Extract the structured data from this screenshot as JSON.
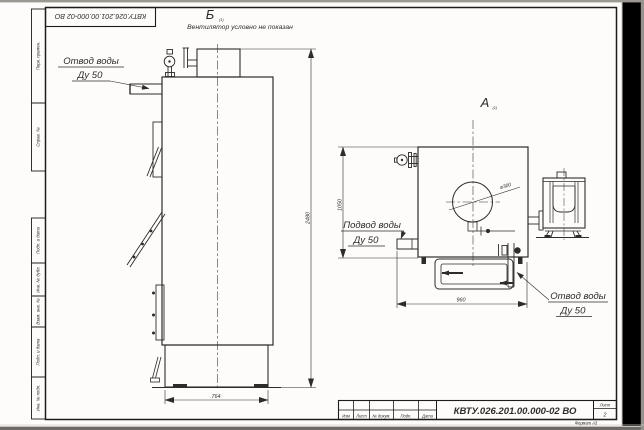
{
  "watermark": {
    "text": "kotel-kv.kz"
  },
  "corner_stamp": {
    "doc_number": "КВТУ.026.201.00.000-02  ВО"
  },
  "margin": [
    "Перв. примен.",
    "Справ. №",
    "Подп. и дата",
    "Инв. № дубл.",
    "Взам. инв. №",
    "Подп. и дата",
    "Инв. № подл."
  ],
  "view_b": {
    "label": "Б",
    "sub": "(1)",
    "note": "Вентилятор условно не показан"
  },
  "view_a": {
    "label": "А",
    "sub": "(1)"
  },
  "callout_outlet_left": {
    "line1": "Отвод воды",
    "line2": "Ду 50"
  },
  "callout_inlet": {
    "line1": "Подвод воды",
    "line2": "Ду 50"
  },
  "callout_outlet_right": {
    "line1": "Отвод воды",
    "line2": "Ду 50"
  },
  "dims": {
    "height": "2480",
    "base": "764",
    "width": "960",
    "front_height": "1050",
    "diameter": "ø300"
  },
  "title_block": {
    "doc_number": "КВТУ.026.201.00.000-02  ВО",
    "izm": "Изм",
    "list": "Лист",
    "doc": "№ докум.",
    "podp": "Подп.",
    "data": "Дата",
    "sheet_label": "Лист",
    "sheet": "2",
    "format": "Формат А3"
  }
}
